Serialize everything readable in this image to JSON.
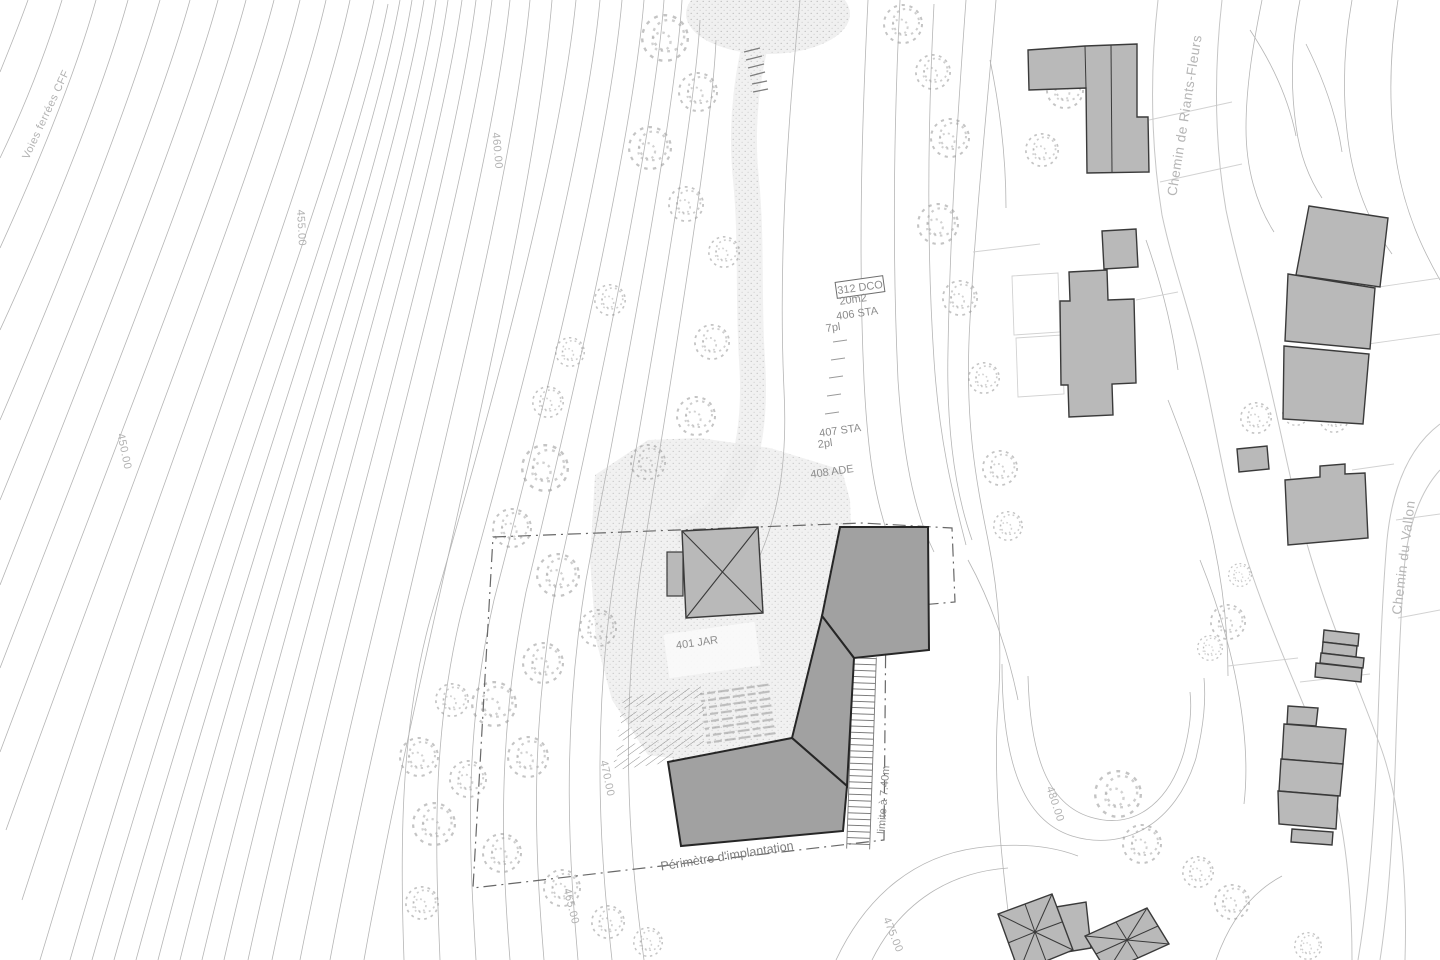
{
  "labels": {
    "railway": "Voies ferrées CFF",
    "street_riants_fleurs": "Chemin de Riants-Fleurs",
    "street_vallon": "Chemin du Vallon",
    "perimeter": "Périmètre d'implantation",
    "limit_740": "limite à 7.40m",
    "parcel_401": "401 JAR",
    "parcel_312": "312 DCO",
    "parcel_312_area": "20m2",
    "parcel_406": "406 STA",
    "parcel_406_places": "7pl",
    "parcel_407": "407 STA",
    "parcel_407_places": "2pl",
    "parcel_408": "408 ADE"
  },
  "contour_labels": {
    "c450": "450.00",
    "c455": "455.00",
    "c460": "460.00",
    "c465": "465.00",
    "c470": "470.00",
    "c475": "475.00",
    "c480": "480.00"
  },
  "colors": {
    "background": "#ffffff",
    "contour": "#b5b5b5",
    "parcel_line": "#d2d2d2",
    "building_fill": "#b9b9b9",
    "building_stroke": "#3a3a3a",
    "proposed_fill": "#a1a1a1",
    "proposed_stroke": "#262626",
    "street_label": "#b5b5b5",
    "parcel_label": "#8c8c8c",
    "perimeter_line": "#686868",
    "vegetation": "#9b9b9b",
    "stipple": "#8e8e8e"
  }
}
